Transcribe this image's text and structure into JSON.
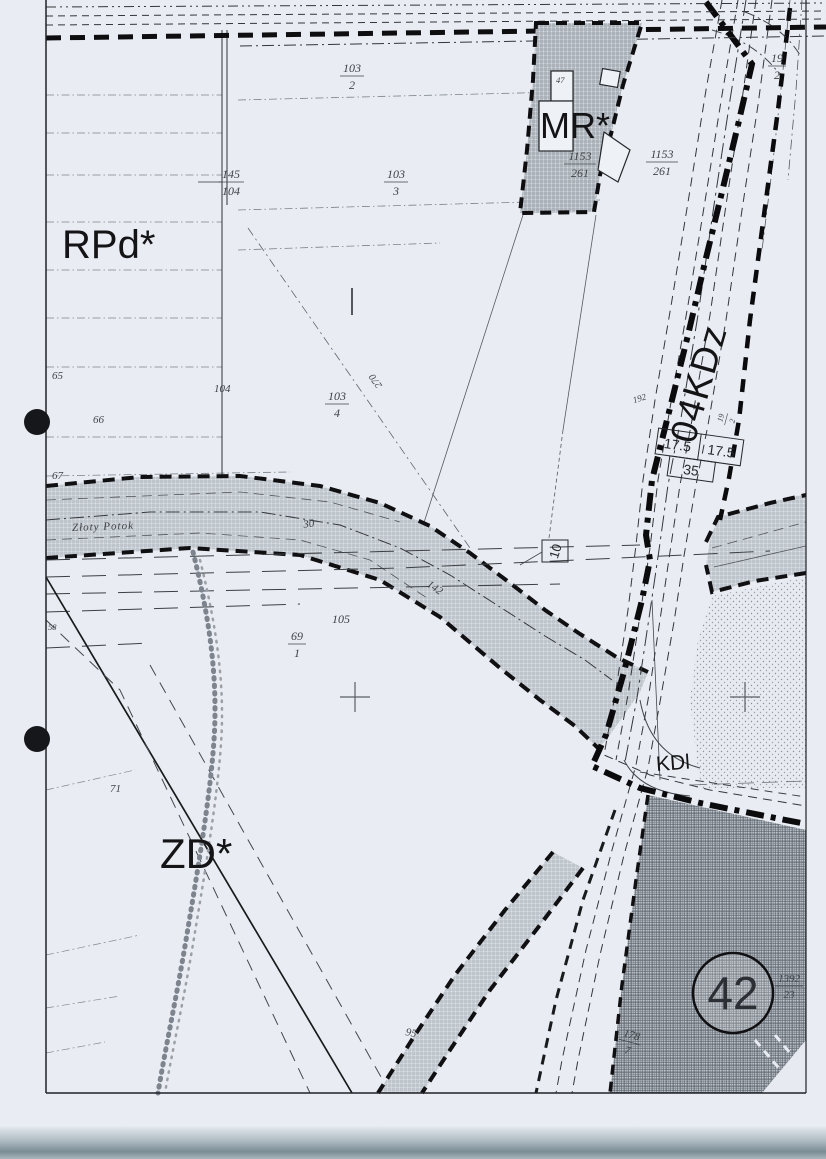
{
  "map": {
    "zones": {
      "rpd": "RPd*",
      "mr": "MR*",
      "zd": "ZD*",
      "road": "04KDz",
      "kdl": "KDl"
    },
    "circle_number": "42",
    "stream_name": "Złoty Potok",
    "numbers": {
      "n65": "65",
      "n66": "66",
      "n67": "67",
      "n104": "104",
      "n58": "58",
      "n71": "71",
      "n30": "30",
      "n142": "142",
      "n105": "105",
      "n95": "95",
      "n47": "47",
      "n270": "270",
      "n192": "192"
    },
    "fractions": [
      {
        "num": "103",
        "den": "2"
      },
      {
        "num": "103",
        "den": "3"
      },
      {
        "num": "145",
        "den": "104"
      },
      {
        "num": "103",
        "den": "4"
      },
      {
        "num": "1153",
        "den": "261"
      },
      {
        "num": "1153",
        "den": "261"
      },
      {
        "num": "19",
        "den": "2"
      },
      {
        "num": "69",
        "den": "1"
      },
      {
        "num": "1392",
        "den": "23"
      },
      {
        "num": "178",
        "den": "7"
      },
      {
        "num": "19",
        "den": "2"
      }
    ],
    "dimensions": {
      "a": "17.5",
      "b": "17.5",
      "c": "35",
      "d": "10"
    },
    "colors": {
      "paper": "#e9edf3",
      "ink": "#1b1b1d",
      "hatch": "#8d949c",
      "dark-hatch": "#5c636b"
    }
  }
}
